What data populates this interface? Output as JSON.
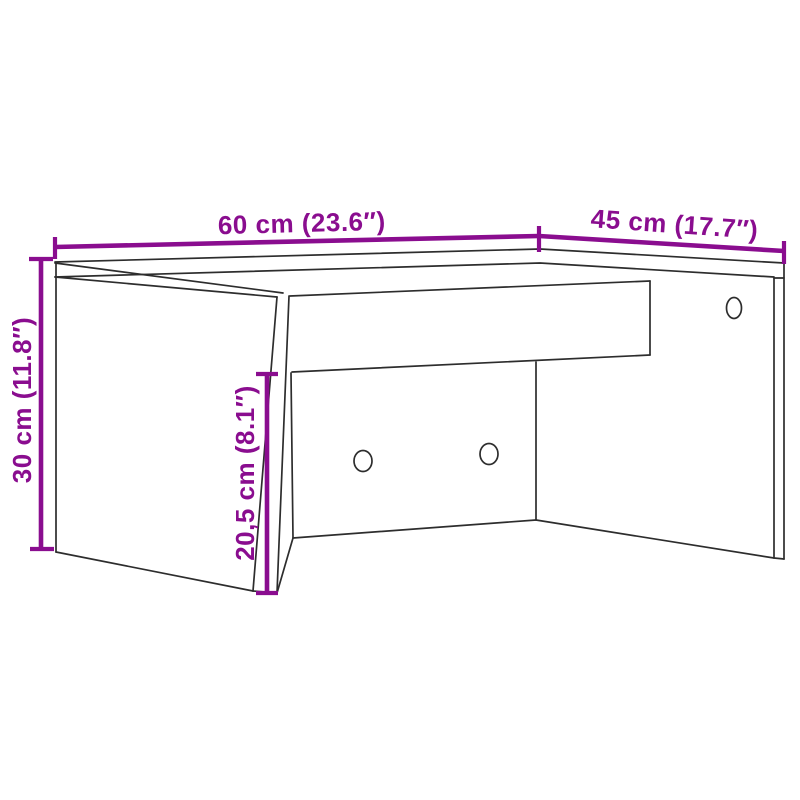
{
  "diagram": {
    "type": "furniture-dimension-line-drawing",
    "dimensions": {
      "width": {
        "label": "60 cm (23.6″)"
      },
      "depth": {
        "label": "45 cm (17.7″)"
      },
      "height": {
        "label": "30 cm (11.8″)"
      },
      "inner_height": {
        "label": "20,5 cm (8.1″)"
      }
    },
    "colors": {
      "dimension": "#8A0D8F",
      "line": "#2D2D2D",
      "background": "#FFFFFF"
    }
  }
}
